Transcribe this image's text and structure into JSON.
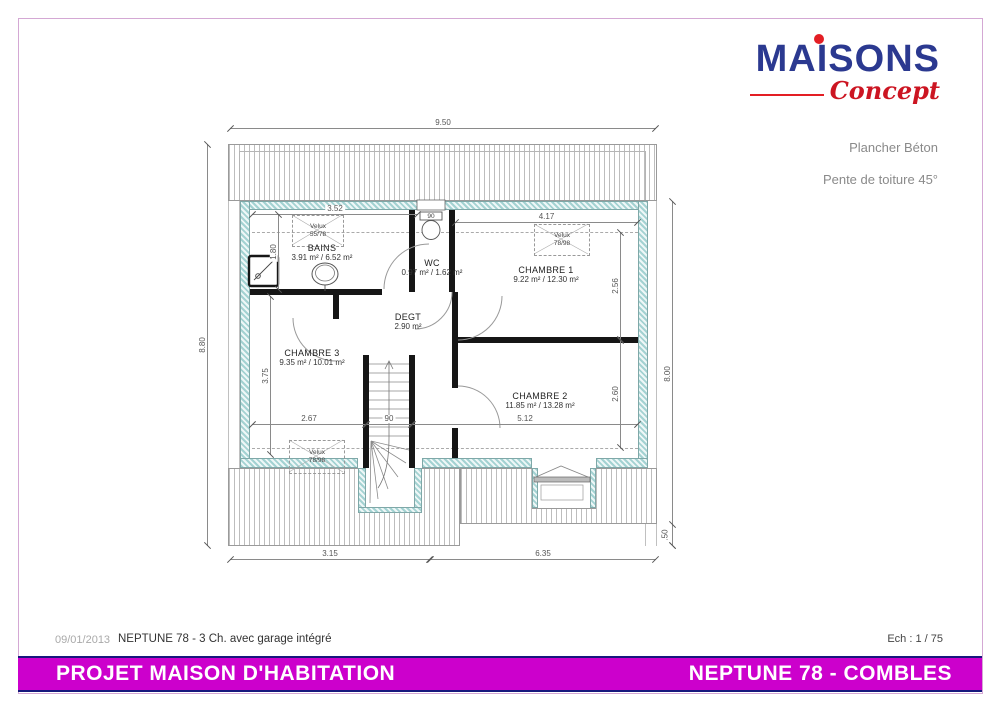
{
  "header": {
    "brand": "MAISONS",
    "brand_sub": "Concept",
    "note1": "Plancher Béton",
    "note2": "Pente de toiture 45°"
  },
  "plan": {
    "rooms": [
      {
        "name": "BAINS",
        "area": "3.91 m² / 6.52 m²"
      },
      {
        "name": "WC",
        "area": "0.97 m² / 1.62 m²"
      },
      {
        "name": "CHAMBRE 1",
        "area": "9.22 m² / 12.30 m²"
      },
      {
        "name": "DEGT",
        "area": "2.90 m²"
      },
      {
        "name": "CHAMBRE 3",
        "area": "9.35 m² / 10.01 m²"
      },
      {
        "name": "CHAMBRE 2",
        "area": "11.85 m² / 13.28 m²"
      }
    ],
    "velux": [
      {
        "label": "Velux",
        "size": "55/78"
      },
      {
        "label": "Velux",
        "size": "78/98"
      },
      {
        "label": "Velux",
        "size": "78/98"
      }
    ],
    "dims": {
      "total_width": "9.50",
      "height_left": "8.80",
      "height_right": "8.00",
      "bottom_seg_left": "3.15",
      "bottom_seg_right": "6.35",
      "roof_offset": ".50",
      "bains_w": "3.52",
      "attic_line": "1.80",
      "ch1_w": "4.17",
      "ch1_d": "2.56",
      "ch2_w": "5.12",
      "ch2_d": "2.60",
      "ch3_w": "2.67",
      "ch3_d": "3.75",
      "stair_w": "90",
      "wc_win": "90"
    }
  },
  "footer": {
    "date": "09/01/2013",
    "model": "NEPTUNE 78 - 3 Ch. avec garage intégré",
    "scale": "Ech : 1 / 75",
    "left_title": "PROJET MAISON D'HABITATION",
    "right_title": "NEPTUNE 78 - COMBLES"
  },
  "colors": {
    "brand_blue": "#2b3990",
    "brand_red": "#e31e24",
    "bar_magenta": "#cc00cc",
    "bar_border": "#17177d",
    "wall_teal": "#a3d2d2"
  }
}
